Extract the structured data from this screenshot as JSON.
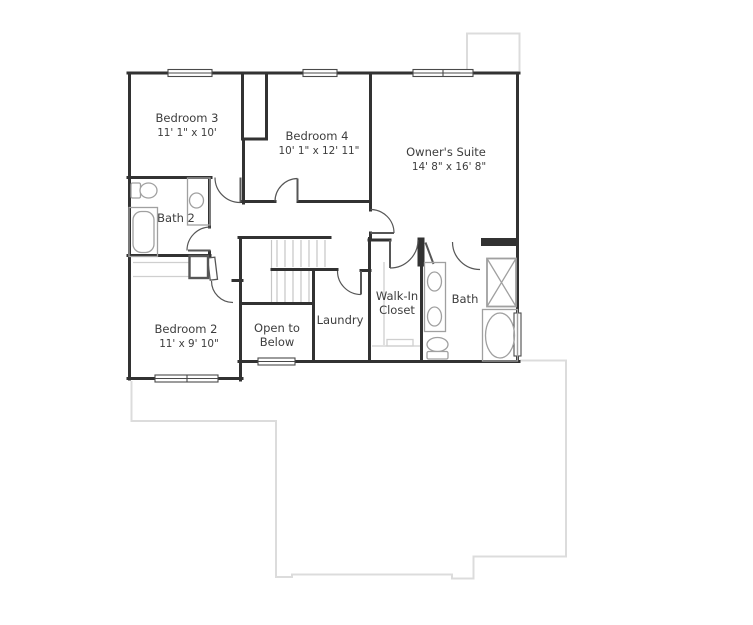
{
  "rooms": {
    "bedroom3": {
      "name": "Bedroom 3",
      "dims": "11' 1\" x 10'"
    },
    "bedroom4": {
      "name": "Bedroom 4",
      "dims": "10' 1\" x 12' 11\""
    },
    "owners_suite": {
      "name": "Owner's Suite",
      "dims": "14' 8\" x 16' 8\""
    },
    "bedroom2": {
      "name": "Bedroom 2",
      "dims": "11' x 9' 10\""
    },
    "bath2": {
      "name": "Bath 2"
    },
    "bath": {
      "name": "Bath"
    },
    "laundry": {
      "name": "Laundry"
    },
    "open_to_below": {
      "line1": "Open to",
      "line2": "Below"
    },
    "walk_in_closet": {
      "line1": "Walk-In",
      "line2": "Closet"
    }
  },
  "colors": {
    "wall": "#323232",
    "window": "#4a4a4a",
    "door": "#565656",
    "fixture": "#a0a0a0",
    "stair": "#c6c6c6",
    "shelf": "#cfcfcf",
    "roof": "#dcdcdc",
    "text": "#3d3d3d"
  }
}
